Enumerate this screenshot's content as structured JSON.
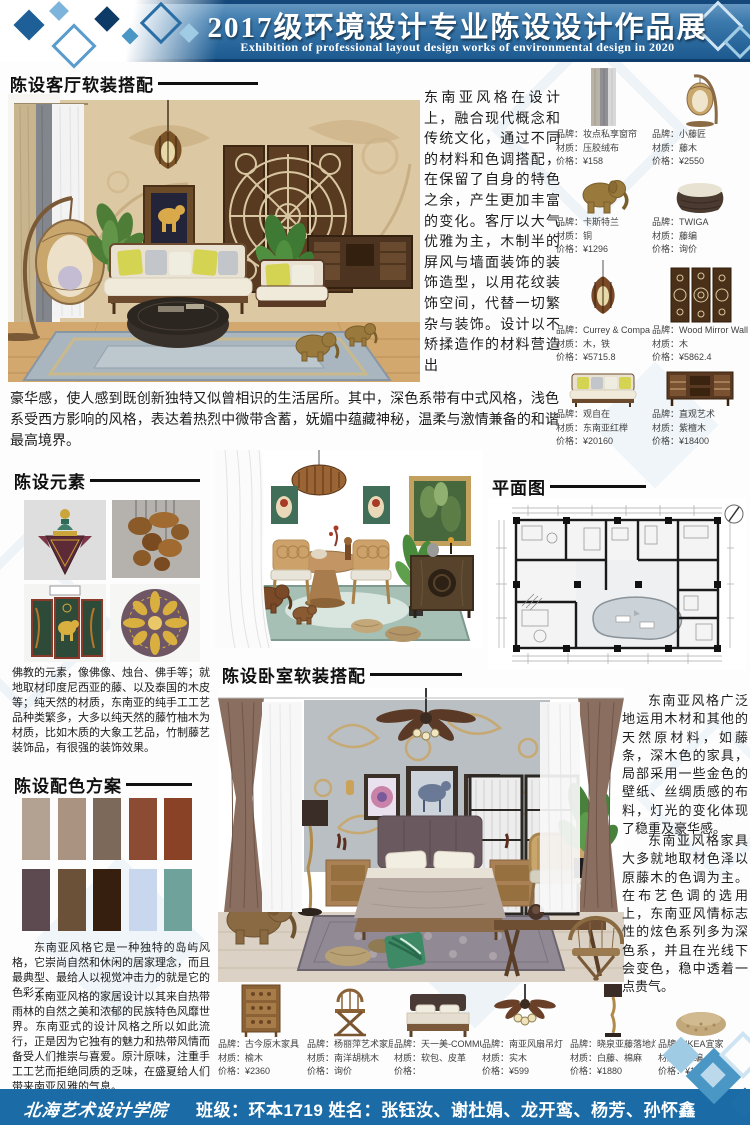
{
  "header": {
    "title": "2017级环境设计专业陈设设计作品展",
    "subtitle": "Exhibition of professional layout design works of environmental design in 2020"
  },
  "footer": {
    "school": "北海艺术设计学院",
    "class_info": "班级：环本1719   姓名：张钰汝、谢杜娟、龙开鸾、杨芳、孙怀鑫"
  },
  "labels": {
    "brand": "品牌：",
    "material": "材质：",
    "price": "价格："
  },
  "sections": {
    "living": {
      "title": "陈设客厅软装搭配",
      "intro": "东南亚风格在设计上，融合现代概念和传统文化，通过不同的材料和色调搭配，在保留了自身的特色之余，产生更加丰富的变化。客厅以大气优雅为主，木制半的屏风与墙面装饰的装饰造型，以用花纹装饰空间，代替一切繁杂与装饰。设计以不矫揉造作的材料营造出",
      "intro_cont": "豪华感，使人感到既创新独特又似曾相识的生活居所。其中，深色系带有中式风格，浅色系受西方影响的风格，表达着热烈中微带含蓄，妩媚中蕴藏神秘，温柔与激情兼备的和谐最高境界。"
    },
    "elements": {
      "title": "陈设元素",
      "body": "佛教的元素，像佛像、烛台、佛手等；就地取材印度尼西亚的藤、以及泰国的木皮等；纯天然的材质，东南亚的纯手工工艺品种类繁多，大多以纯天然的藤竹柚木为材质，比如木质的大象工艺品，竹制藤艺装饰品，有很强的装饰效果。"
    },
    "palette": {
      "title": "陈设配色方案",
      "swatches": [
        "#b3a192",
        "#ab9382",
        "#7d695a",
        "#8c4b33",
        "#8a4227",
        "#5d4a50",
        "#6b5138",
        "#371f10",
        "#c9d7ee",
        "#6fa29b"
      ],
      "para1": "东南亚风格它是一种独特的岛屿风格，它崇尚自然和休闲的居家理念，而且最典型、最给人以视觉冲击力的就是它的色彩了。",
      "para2": "东南亚风格的家居设计以其来自热带雨林的自然之美和浓郁的民族特色风靡世界。东南亚式的设计风格之所以如此流行，正是因为它独有的魅力和热带风情而备受人们推崇与喜爱。原汁原味，注重手工工艺而拒绝同质的乏味，在盛夏给人们带来南亚风雅的气息。"
    },
    "plan": {
      "title": "平面图"
    },
    "bedroom": {
      "title": "陈设卧室软装搭配",
      "body1": "东南亚风格广泛地运用木材和其他的天然原材料，如藤条，深木色的家具，局部采用一些金色的壁纸、丝绸质感的布料，灯光的变化体现了稳重及豪华感。",
      "body2": "东南亚风格家具大多就地取材色泽以原藤木的色调为主。在布艺色调的选用上，东南亚风情标志性的炫色系列多为深色系，并且在光线下会变色，稳中透着一点贵气。"
    }
  },
  "products_top": [
    {
      "brand": "妆点私享窗帘",
      "material": "压胶绒布",
      "price": "¥158"
    },
    {
      "brand": "小藤匠",
      "material": "藤木",
      "price": "¥2550"
    },
    {
      "brand": "卡斯特兰",
      "material": "铜",
      "price": "¥1296"
    },
    {
      "brand": "TWIGA",
      "material": "藤编",
      "price": "询价"
    },
    {
      "brand": "Currey & Company",
      "material": "木，铁",
      "price": "¥5715.8"
    },
    {
      "brand": "Wood Mirror Wall Pane",
      "material": "木",
      "price": "¥5862.4"
    },
    {
      "brand": "观自在",
      "material": "东南亚红榉",
      "price": "¥20160"
    },
    {
      "brand": "直观艺术",
      "material": "紫檀木",
      "price": "¥18400"
    }
  ],
  "products_bottom": [
    {
      "brand": "古今原木家具",
      "material": "榆木",
      "price": "¥2360"
    },
    {
      "brand": "杨丽萍艺术家居",
      "material": "南洋胡桃木",
      "price": "询价"
    },
    {
      "brand": "天一美-COMMUNE",
      "material": "软包、皮革",
      "price": ""
    },
    {
      "brand": "南亚风扇吊灯",
      "material": "实木",
      "price": "¥599"
    },
    {
      "brand": "晓泉亚藤落地灯",
      "material": "白藤、棉麻",
      "price": "¥1880"
    },
    {
      "brand": "IKEA宜家",
      "material": "藤编",
      "price": "¥179"
    }
  ],
  "colors": {
    "banner_blue": "#2e6da4",
    "banner_dark": "#123f6b",
    "footer_blue": "#1a6ba6",
    "diamond_light": "#9fcbe4",
    "diamond_mid": "#4a97c6"
  }
}
